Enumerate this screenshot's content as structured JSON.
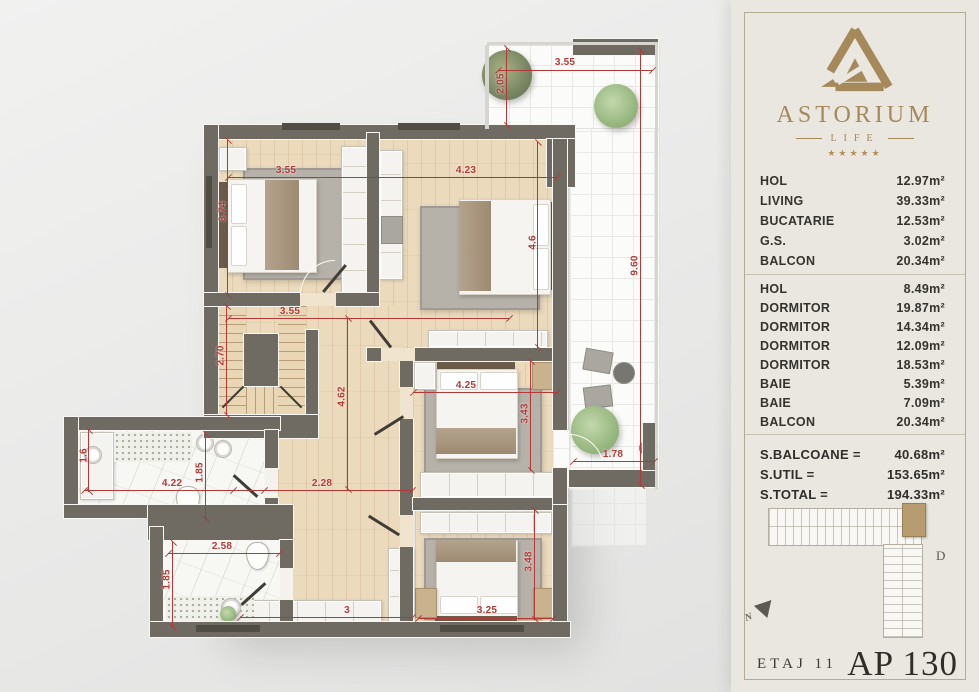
{
  "panel": {
    "brand": {
      "name": "ASTORIUM",
      "sub": "LIFE",
      "stars": "★★★★★"
    },
    "rooms": [
      {
        "name": "HOL",
        "area": "12.97m²"
      },
      {
        "name": "LIVING",
        "area": "39.33m²"
      },
      {
        "name": "BUCATARIE",
        "area": "12.53m²"
      },
      {
        "name": "G.S.",
        "area": "3.02m²"
      },
      {
        "name": "BALCON",
        "area": "20.34m²"
      },
      {
        "name": "HOL",
        "area": "8.49m²"
      },
      {
        "name": "DORMITOR",
        "area": "19.87m²"
      },
      {
        "name": "DORMITOR",
        "area": "14.34m²"
      },
      {
        "name": "DORMITOR",
        "area": "12.09m²"
      },
      {
        "name": "DORMITOR",
        "area": "18.53m²"
      },
      {
        "name": "BAIE",
        "area": "5.39m²"
      },
      {
        "name": "BAIE",
        "area": "7.09m²"
      },
      {
        "name": "BALCON",
        "area": "20.34m²"
      }
    ],
    "totals": [
      {
        "label": "S.BALCOANE =",
        "value": "40.68m²"
      },
      {
        "label": "S.UTIL =",
        "value": "153.65m²"
      },
      {
        "label": "S.TOTAL =",
        "value": "194.33m²"
      }
    ],
    "building_letter": "D",
    "north_letter": "N",
    "floor_label": "ETAJ 11",
    "apartment_label": "AP 130"
  },
  "plan": {
    "dims": {
      "bedroom1_width": "3.55",
      "bedroom1_depth": "3.74",
      "bedroom2_width": "4.23",
      "bedroom2_depth": "4.6",
      "bedroom3_width": "4.25",
      "bedroom3_depth": "3.43",
      "bedroom4_width": "3.25",
      "bedroom4_depth": "3.48",
      "stairs_width": "3.55",
      "stairs_depth": "2.70",
      "hall_length": "4.62",
      "hall_width": "2.28",
      "wardrobe_length": "3",
      "bath1_left": "1.6",
      "bath1_width": "4.22",
      "bath1_depth": "1.85",
      "bath2_width": "2.58",
      "bath2_depth": "1.85",
      "balcony_top_width": "3.55",
      "balcony_top_depth": "2.05",
      "balcony_right_length": "9.60",
      "balcony_right_width": "1.78"
    }
  },
  "colors": {
    "accent_gold": "#a5895a",
    "dimension_red": "#b23a36",
    "wall_gray": "#6f6b62",
    "wood_floor": "#ecdabd",
    "panel_background": "#eae7e0",
    "highlight_unit_tan": "#b69c6f"
  }
}
